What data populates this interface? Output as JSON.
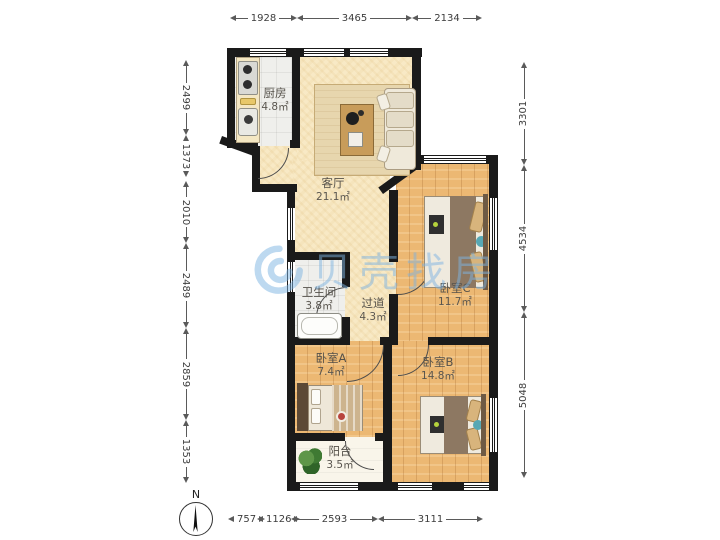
{
  "watermark": {
    "brand": "贝壳找房",
    "color": "#7eb4e2"
  },
  "compass": {
    "north_label": "N"
  },
  "rooms": {
    "kitchen": {
      "name": "厨房",
      "area": "4.8㎡"
    },
    "living": {
      "name": "客厅",
      "area": "21.1㎡"
    },
    "bathroom": {
      "name": "卫生间",
      "area": "3.8㎡"
    },
    "hallway": {
      "name": "过道",
      "area": "4.3㎡"
    },
    "bedroom_a": {
      "name": "卧室A",
      "area": "7.4㎡"
    },
    "bedroom_b": {
      "name": "卧室B",
      "area": "14.8㎡"
    },
    "bedroom_c": {
      "name": "卧室C",
      "area": "11.7㎡"
    },
    "balcony": {
      "name": "阳台",
      "area": "3.5㎡"
    }
  },
  "dimensions_mm": {
    "top": [
      "1928",
      "3465",
      "2134"
    ],
    "left": [
      "2499",
      "1373",
      "2010",
      "2489",
      "2859",
      "1353"
    ],
    "right": [
      "3301",
      "4534",
      "5048"
    ],
    "bottom": [
      "757",
      "1126",
      "2593",
      "3111"
    ]
  },
  "colors": {
    "wall": "#1a1a1a",
    "wood_floor": "#ecb873",
    "living_floor": "#f8e9c5",
    "tile_floor": "#efefec",
    "watermark_blue": "#7eb4e2"
  }
}
